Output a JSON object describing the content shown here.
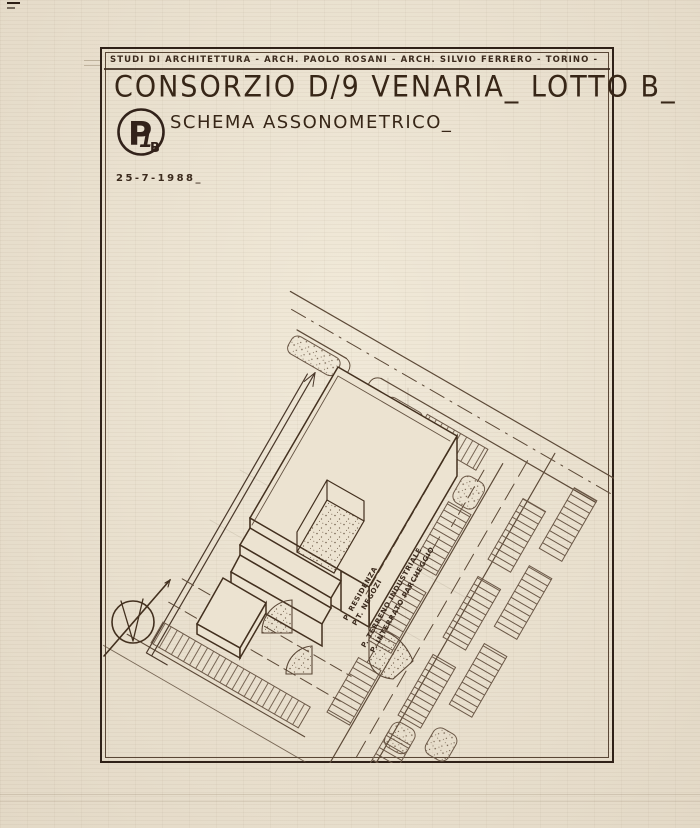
{
  "sheet": {
    "studio_line": "STUDI DI ARCHITETTURA - ARCH. PAOLO ROSANI - ARCH. SILVIO FERRERO - TORINO -",
    "title": "CONSORZIO D/9 VENARIA_ LOTTO B_",
    "subtitle": "SCHEMA ASSONOMETRICO_",
    "date": "25-7-1988_",
    "logo": {
      "p": "P",
      "one": "1",
      "b": "B"
    }
  },
  "drawing": {
    "levels": {
      "l15": "+15.00",
      "l11": "+11.00",
      "l7": "+ 7.00",
      "l0": "±0.00",
      "lm4": "-4.00"
    },
    "annotations": {
      "a1": "P. RESIDENZA",
      "a2": "P.T. NEGOZI",
      "a3": "P. TERRENO INDUSTRIALE",
      "a4": "P. INTERRATO PARCHEGGIO"
    }
  },
  "colors": {
    "paper": "#ece3d1",
    "ink": "#3b2a1d",
    "line": "#5d4a38",
    "light": "#8a7765"
  }
}
